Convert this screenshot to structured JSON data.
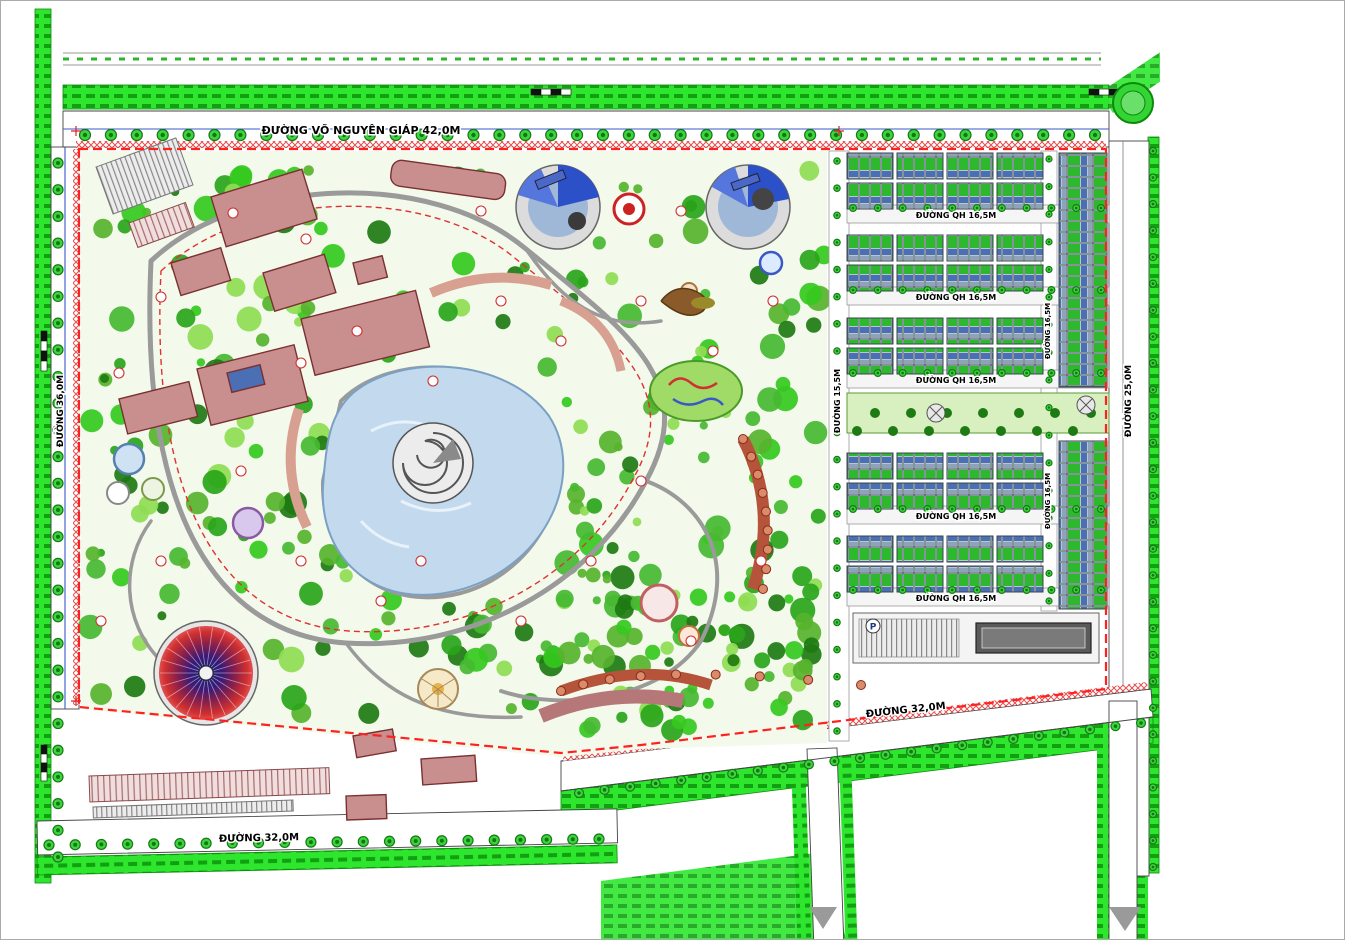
{
  "title_block": {
    "title": "QUY HOẠCH CHI TIẾT TỶ LỆ 1/500 CÔNG VIÊN CHỦ ĐỀ KẾT HỢP NHÀ Ở TẠI THÀNH PHỐ PHỦ LÝ (PL-BT11.22)",
    "subtitle": "(THUỘC XÃ TIÊN HIỆP, THÀNH PHỐ PHỦ LÝ, TỈNH HÀ NAM)",
    "north_label": "B",
    "scale_label": "TỶ LỆ XÍCH",
    "scale_ticks": [
      "0M",
      "10M",
      "25M",
      "50M"
    ]
  },
  "land_use_table": {
    "headers": [
      "STT",
      "LOẠI ĐẤT",
      "KÝ HIỆU",
      "SỐ LÔ",
      "DIỆN TÍCH (M2)",
      "TỶ LỆ (%)"
    ]
  },
  "approvals": [
    {
      "heading": "CƠ QUAN PHÊ DUYỆT\nUBND TỈNH HÀ NAM",
      "date_line": "NGÀY    /    NĂM"
    },
    {
      "heading": "CƠ QUAN THẨM ĐỊNH\nSỞ XÂY DỰNG TỈNH HÀ NAM",
      "date_line": "NGÀY    /    NĂM"
    },
    {
      "heading": "ỦY BAN NHÂN DÂN THÀNH PHỐ PHỦ LÝ",
      "date_line": "NGÀY    /    NĂM"
    },
    {
      "heading": "CƠ QUAN TỔ CHỨC LẬP QUY HOẠCH\nBAN QUẢN LÝ DỰ ÁN ĐẦU TƯ QUY HOẠCH - SỞ XÂY DỰNG TỈNH HÀ NAM",
      "date_line": "NGÀY    /    NĂM"
    }
  ],
  "project_block": {
    "label": "CÔNG TRÌNH - ĐỊA ĐIỂM",
    "line1": "QUY HOẠCH CHI TIẾT TỶ LỆ 1/500 CÔNG VIÊN CHỦ ĐỀ",
    "line2": "KẾT HỢP NHÀ Ở TẠI THÀNH PHỐ PHỦ LÝ (PL-BT11.22)"
  },
  "drawing_block": {
    "label": "TÊN BẢN VẼ:",
    "name": "SƠ ĐỒ TỔ CHỨC KHÔNG GIAN, KIẾN TRÚC, CẢNH QUAN",
    "rows": [
      {
        "label": "BẢN VẼ: QH-04",
        "value": "KHỔ: 1.A3   TỶ LỆ: 1/T",
        "right": "NGÀY:   /   2022"
      },
      {
        "label": "THIẾT KẾ",
        "value": "KTS. ĐINH THỊ ÁNH KIỀU",
        "right": ""
      },
      {
        "label": "CHỦ TRÌ",
        "value": "KTS. NGUYỄN THỊ THANH TÌNH",
        "right": ""
      },
      {
        "label": "CHỦ NHIỆM",
        "value": "KTS. NGUYỄN THANH BÌNH",
        "right": ""
      },
      {
        "label": "QL. KỸ THUẬT",
        "value": "KS. NGUYỄN VĂN BỘ",
        "right": ""
      }
    ],
    "director_label": "GIÁM ĐỐC",
    "signature": "LÊ LONG ANH"
  },
  "company_block": {
    "logo": "mp",
    "name": "CÔNG TY TNHH KIẾN TRÚC MP"
  },
  "plan": {
    "roads": {
      "vo_nguyen_giap": "ĐƯỜNG VÕ NGUYÊN GIÁP 42,0M",
      "left": "ĐƯỜNG 36,0M",
      "right": "ĐƯỜNG 25,0M",
      "mid_vertical": "ĐƯỜNG 15,5M",
      "housing_vertical": "ĐƯỜNG 16,5M",
      "qh": "ĐƯỜNG QH 16,5M",
      "bottom": "ĐƯỜNG 32,0M"
    },
    "parking_label": "P"
  },
  "colors": {
    "boundary_red": "#ff2020",
    "tree_bright": "#35c91e",
    "tree_dark": "#1e7a12",
    "building_pink": "#c98f8f",
    "water_blue": "#c2d9ee",
    "roof_green": "#2eb82e",
    "roof_blue": "#4a6fb5"
  }
}
